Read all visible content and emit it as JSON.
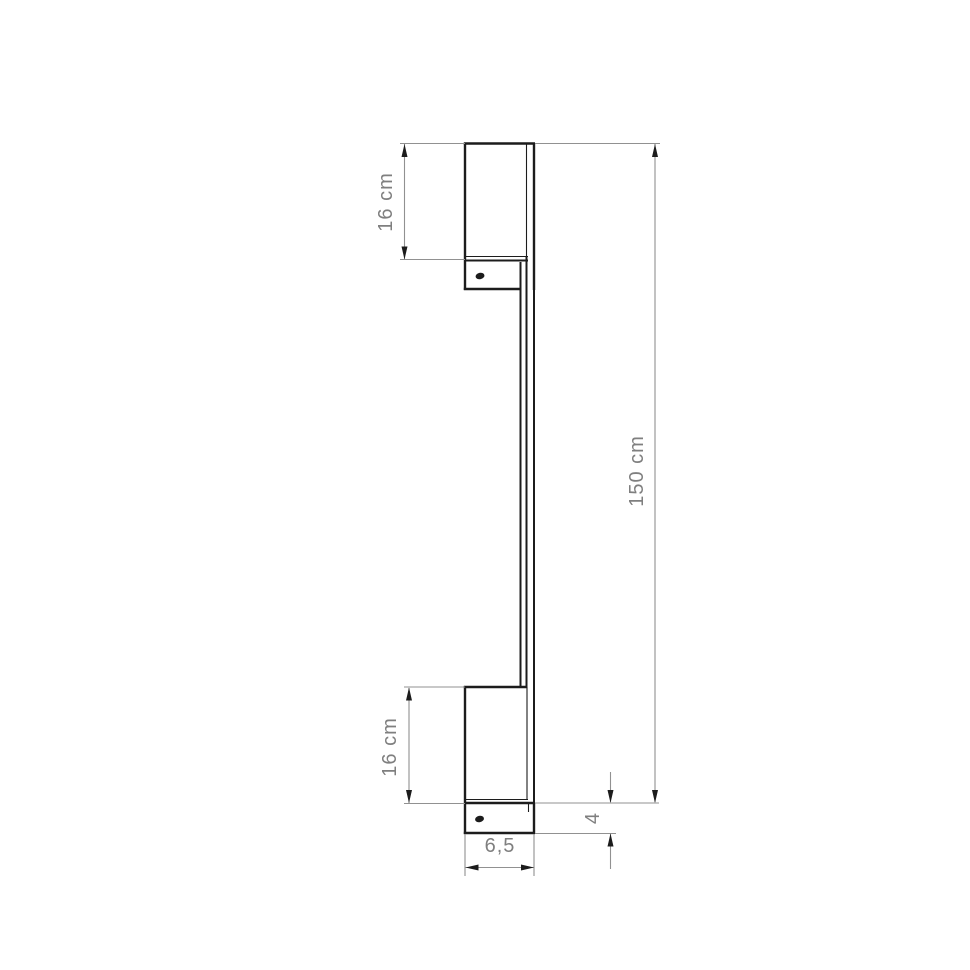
{
  "drawing": {
    "type": "technical-dimension-drawing",
    "object": "wall-mounted linear lamp, side view",
    "dimensions": {
      "top_bracket_height": "16 cm",
      "total_height": "150 cm",
      "bottom_bracket_height": "16 cm",
      "base_depth": "4",
      "base_width": "6,5"
    },
    "colors": {
      "object_line": "#1c1c1c",
      "dimension_line": "#919191",
      "label_text": "#7f7f7f",
      "background": "#ffffff"
    }
  }
}
